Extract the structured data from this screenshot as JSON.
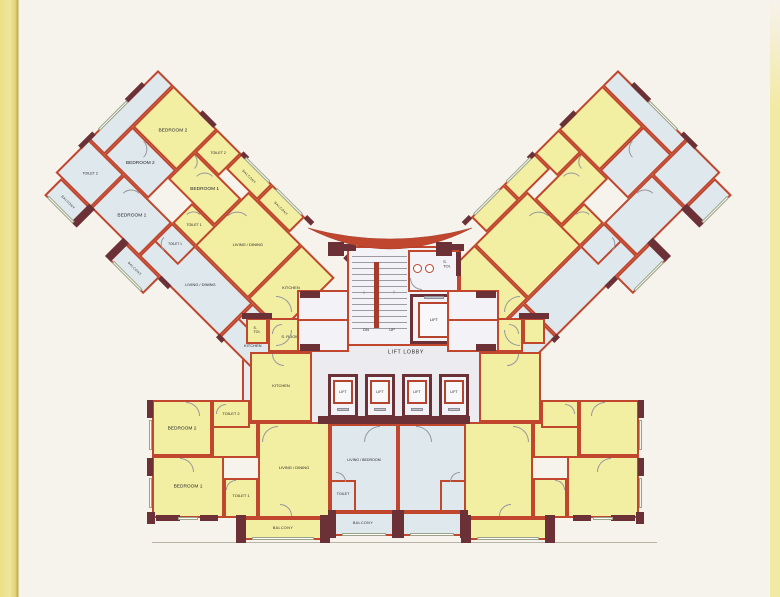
{
  "page": {
    "background": "#f6f2ec",
    "left_edge_color": "#ece189",
    "right_edge_color": "#f2eaa4"
  },
  "colors": {
    "unit_yellow": "#f3efa2",
    "unit_blue": "#dfe9ed",
    "lobby_floor": "#ebebf0",
    "wall_red": "#c0462e",
    "wall_dark": "#6c3136",
    "window_line": "#9aa38b"
  },
  "core": {
    "lobby_label": "LIFT LOBBY",
    "stair_dn": "DN",
    "stair_up": "UP",
    "stair_down_arrow": "↓",
    "stair_up_arrow": "↑",
    "s_toi_line1": "S.",
    "s_toi_line2": "TOI.",
    "fireman_lift_label": "LIFT",
    "lift_labels": [
      "LIFT",
      "LIFT",
      "LIFT",
      "LIFT"
    ]
  },
  "wing_upper_left": {
    "unit_yellow": {
      "bedroom2": "BEDROOM 2",
      "toilet2": "TOILET 2",
      "balcony_1": "BALCONY",
      "bedroom1": "BEDROOM 1",
      "toilet1": "TOILET 1",
      "living_dining": "LIVING / DINING",
      "balcony_2": "BALCONY",
      "kitchen": "KITCHEN"
    },
    "unit_blue": {
      "bedroom2": "BEDROOM 2",
      "toilet2": "TOILET 2",
      "bedroom1": "BEDROOM 1",
      "toilet1": "TOILET 1",
      "living_dining": "LIVING / DINING",
      "kitchen": "KITCHEN",
      "s_toi_line1": "S.",
      "s_toi_line2": "TOI",
      "balcony_1": "BALCONY",
      "balcony_2": "BALCONY"
    }
  },
  "unit_bottom_left": {
    "s_toi_line1": "S.",
    "s_toi_line2": "TOI.",
    "s_room": "S. ROOM",
    "kitchen": "KITCHEN",
    "toilet2": "TOILET 2",
    "bedroom2": "BEDROOM 2",
    "bedroom1": "BEDROOM 1",
    "toilet1": "TOILET 1",
    "living_dining": "LIVING / DINING",
    "balcony": "BALCONY"
  },
  "studio": {
    "living_bedroom": "LIVING / BEDROOM",
    "toilet": "TOILET",
    "balcony": "BALCONY"
  }
}
